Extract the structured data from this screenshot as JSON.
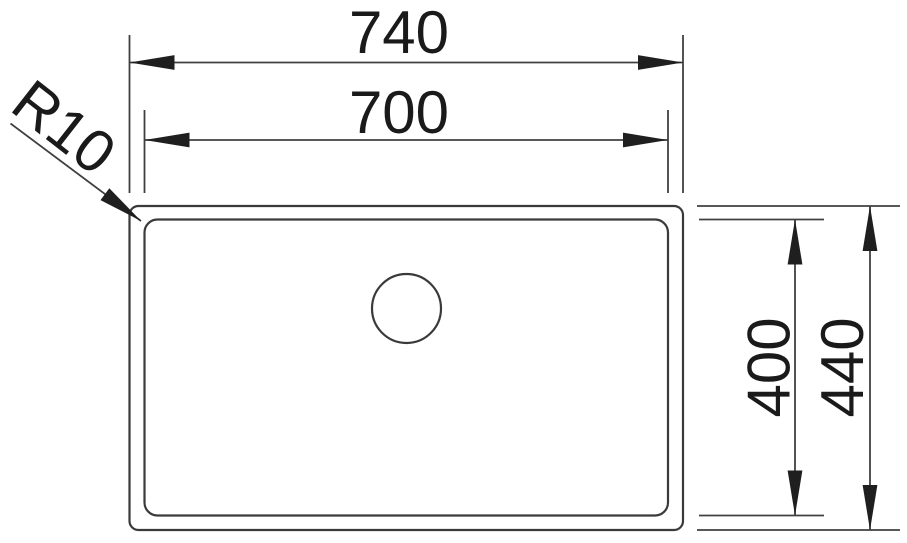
{
  "drawing": {
    "type": "technical-dimension-drawing",
    "background": "#ffffff",
    "line_color": "#3a3a3a",
    "text_color": "#1a1a1a",
    "labels": {
      "overall_width": "740",
      "inner_width": "700",
      "inner_depth": "400",
      "overall_depth": "440",
      "corner_radius": "R10"
    }
  }
}
